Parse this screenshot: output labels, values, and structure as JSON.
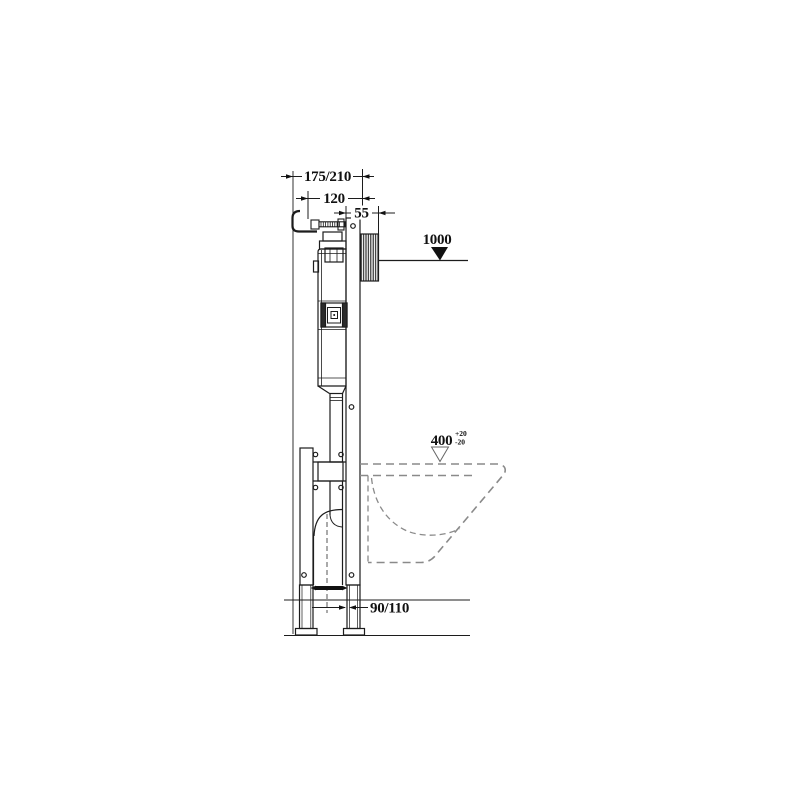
{
  "diagram": {
    "dimensions": {
      "frame_depth": "175/210",
      "supply_offset": "120",
      "plate_depth": "55",
      "button_height": "1000",
      "pan_height": "400",
      "pan_height_tol_upper": "+20",
      "pan_height_tol_lower": "-20",
      "outlet_offset": "90/110"
    },
    "colors": {
      "line": "#1c1c1c",
      "pan_dashed": "#8a8a8a",
      "background": "#ffffff"
    }
  }
}
